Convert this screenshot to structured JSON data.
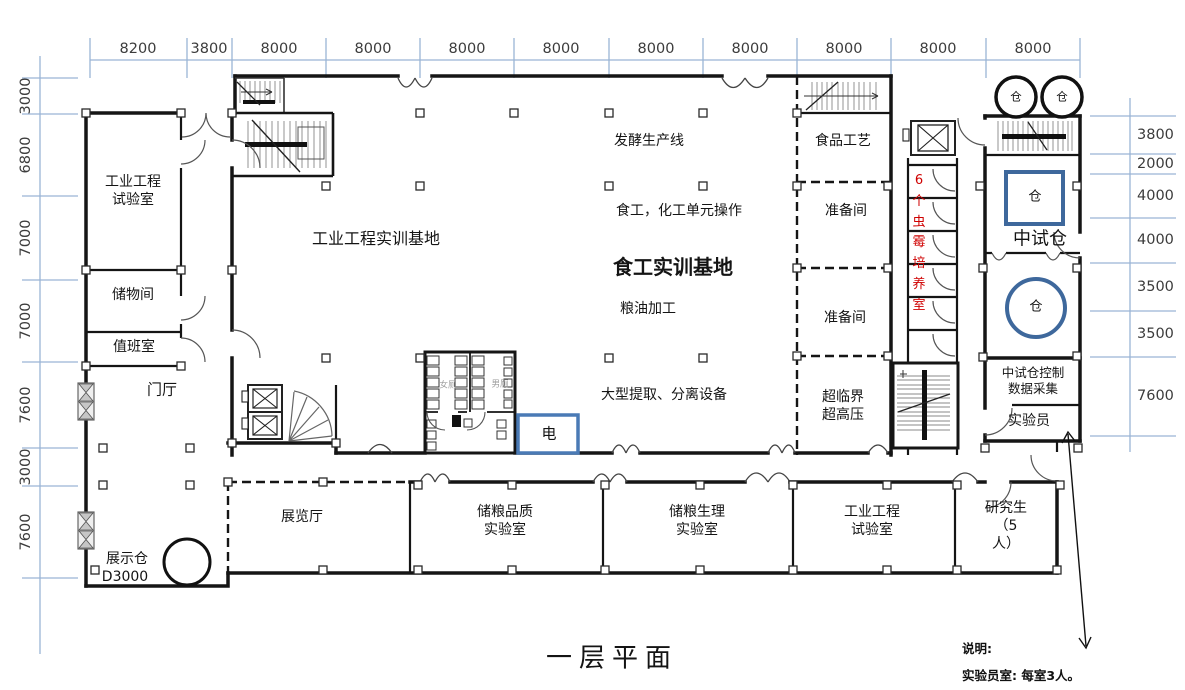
{
  "title": "一层平面",
  "dims": {
    "top": [
      "8200",
      "3800",
      "8000",
      "8000",
      "8000",
      "8000",
      "8000",
      "8000",
      "8000",
      "8000",
      "8000"
    ],
    "left": [
      "3000",
      "6800",
      "7000",
      "7000",
      "7600",
      "3000",
      "7600"
    ],
    "right": [
      "3800",
      "2000",
      "4000",
      "4000",
      "3500",
      "3500",
      "7600"
    ]
  },
  "labels": {
    "ie_test_left": "工业工程\n试验室",
    "storage": "储物间",
    "duty_room": "值班室",
    "foyer": "门厅",
    "display_silo": "展示仓",
    "display_silo_code": "D3000",
    "exhibition_hall": "展览厅",
    "ie_training_base": "工业工程实训基地",
    "fermentation_line": "发酵生产线",
    "unit_operations": "食工，化工单元操作",
    "food_training_base": "食工实训基地",
    "grain_oil_processing": "粮油加工",
    "extraction_equipment": "大型提取、分离设备",
    "food_technology": "食品工艺",
    "prep_room_1": "准备间",
    "prep_room_2": "准备间",
    "supercritical": "超临界\n超高压",
    "electric_room": "电",
    "toilet_women": "女厕",
    "toilet_men": "男厕",
    "mold_culture_rooms": "6\n个\n虫\n霉\n培\n养\n室",
    "pilot_silo": "中试仓",
    "silo": "仓",
    "control_room": "中试仓控制\n数据采集",
    "lab_technician": "实验员",
    "grain_quality_lab": "储粮品质\n实验室",
    "grain_physiology_lab": "储粮生理\n实验室",
    "ie_test_bottom": "工业工程\n试验室",
    "graduate_room": "研究生\n（5\n人）"
  },
  "notes": {
    "heading": "说明:",
    "body": "实验员室: 每室3人。"
  },
  "colors": {
    "dimension_line": "#9ab5d5",
    "wall": "#151515",
    "blue_equipment": "#3e689c",
    "red_annotation": "#cf0000"
  }
}
